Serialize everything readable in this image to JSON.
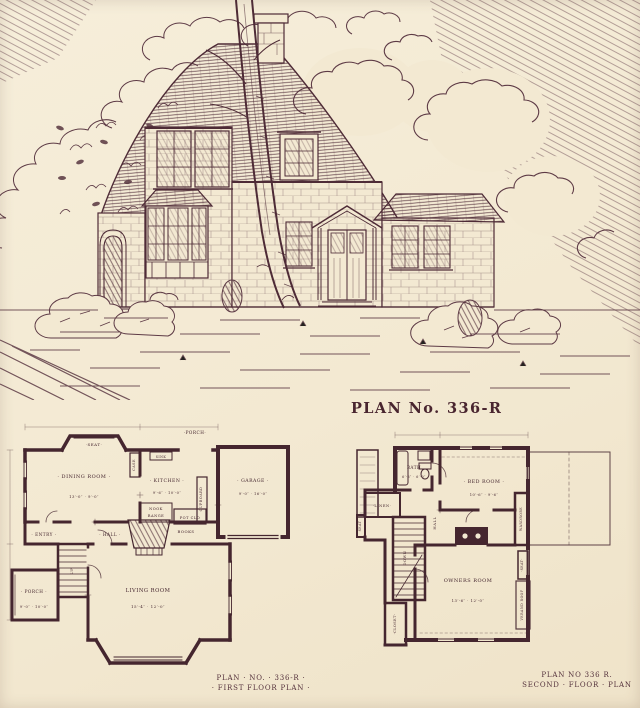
{
  "page": {
    "title": "PLAN No. 336-R"
  },
  "colors": {
    "paper": "#f3e9d2",
    "ink": "#4e2b36",
    "plan_ink": "#45262f"
  },
  "illustration": {
    "alt": "Pen-and-ink perspective rendering of a shingle-clad cottage with sweeping roof, center chimney, bay window, arched side door, entry portico and garage wing, with tree and shrubs"
  },
  "first_floor": {
    "caption_line1": "PLAN · NO. · 336-R ·",
    "caption_line2": "· FIRST FLOOR PLAN ·",
    "rooms": {
      "seat": "·SEAT·",
      "porch_top": "·PORCH·",
      "dining": "· DINING ROOM ·",
      "dining_dims": "13′-0″ · 9′-0″",
      "case": "CASE",
      "sink": "SINK",
      "kitchen": "· KITCHEN ·",
      "kitchen_dims": "9′-6″ · 10′-0″",
      "garage": "· GARAGE ·",
      "garage_dims": "9′-0″ · 16′-0″",
      "nook": "NOOK",
      "range": "RANGE",
      "cupboard": "CUPBOARD",
      "pot_closet": "POT CLO",
      "entry": "· ENTRY ·",
      "hall": "· HALL ·",
      "up": "UP",
      "books": "BOOKS",
      "porch_side": "· PORCH ·",
      "porch_side_dims": "9′-0″ · 10′-0″",
      "living": "LIVING ROOM",
      "living_dims": "15′-4″ · 12′-0″"
    }
  },
  "second_floor": {
    "caption_line1": "PLAN NO 336 R.",
    "caption_line2": "SECOND · FLOOR · PLAN",
    "rooms": {
      "bath": "BATH",
      "bath_dims": "6′-6″ · 6′-0″",
      "bed": "· BED ROOM ·",
      "bed_dims": "10′-6″ · 9′-6″",
      "wardrobe": "WARDROBE",
      "linen": "·LINEN·",
      "seat_left": "SEAT",
      "down": "DOWN",
      "hall": "HALL",
      "closet": "·CLOSET·",
      "owners": "OWNERS ROOM",
      "owners_dims": "13′-6″ · 12′-0″",
      "seat_right": "·SEAT·",
      "veranda_roof": "VERAND ROOF"
    }
  }
}
